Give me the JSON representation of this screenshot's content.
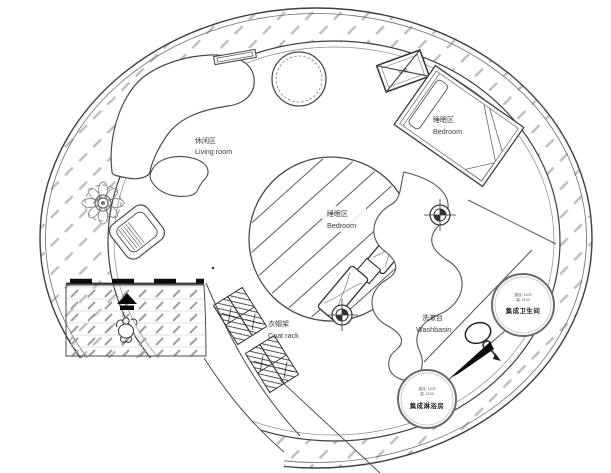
{
  "zones": {
    "living_room": {
      "zh": "休闲区",
      "en": "Living room"
    },
    "bedroom_window": {
      "zh": "睡眠区",
      "en": "Bedroom"
    },
    "bedroom_loft": {
      "zh": "睡眠区",
      "en": "Bedroom"
    },
    "coat_rack": {
      "zh": "衣帽架",
      "en": "Coat rack"
    },
    "washbasin": {
      "zh": "洗漱台",
      "en": "Washbasin"
    }
  },
  "pods": {
    "bathroom": {
      "spec_diameter": "直径: 1100",
      "spec_height": "高: 2100",
      "name": "集成卫生间"
    },
    "shower": {
      "spec_diameter": "直径: 1100",
      "spec_height": "高: 2100",
      "name": "集成淋浴房"
    }
  },
  "equipment": {
    "ac_unit": "空调"
  },
  "icons": {
    "downlight": "crosshair-target",
    "entrance_arrow": "up-arrow",
    "person": "walking-person-top-view",
    "faucet": "loop-faucet",
    "flow_arrow": "solid-tapered-arrow",
    "plant": "potted-plant-top-view"
  },
  "colors": {
    "wall_line": "#3f3f3f",
    "ring_hatch": "#bdbdbd",
    "deck_hatch": "#9e9e9e",
    "black": "#0a0a0a",
    "background": "#ffffff"
  }
}
